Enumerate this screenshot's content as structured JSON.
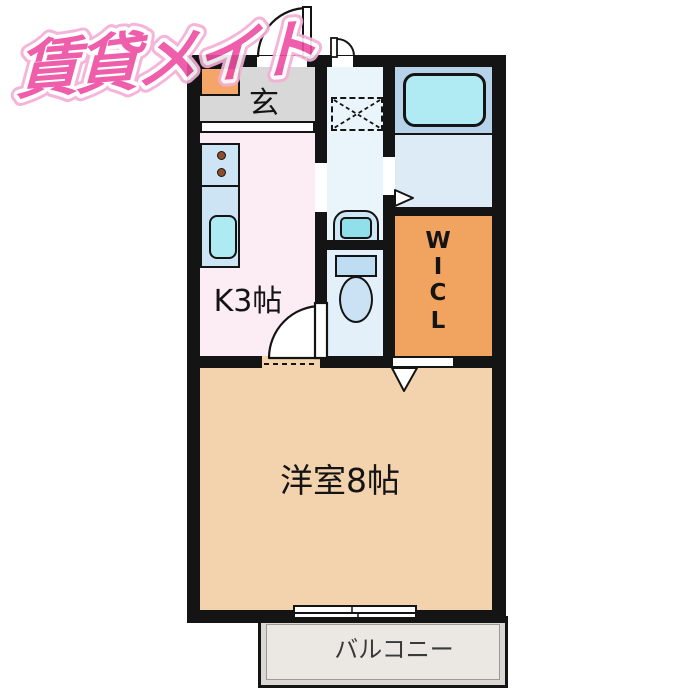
{
  "logo": {
    "text": "賃貸メイト",
    "color": "#ee4da1"
  },
  "plan": {
    "rooms": {
      "entrance": {
        "label": "玄",
        "floor_color": "#d8d8d8"
      },
      "kitchen": {
        "label": "K3帖",
        "floor_color": "#fbedf3"
      },
      "walk_in_closet": {
        "letters": [
          "W",
          "I",
          "C",
          "L"
        ],
        "floor_color": "#f0a45f"
      },
      "living": {
        "label": "洋室8帖",
        "floor_color": "#f3d3ad"
      },
      "balcony": {
        "label": "バルコニー",
        "floor_color": "#dbd7d3"
      },
      "washroom": {
        "floor_color": "#e9f4fb"
      },
      "toilet": {
        "floor_color": "#e3f0fa"
      },
      "bathroom": {
        "floor_color": "#dcebf6"
      }
    },
    "fixtures": [
      "shoe-cabinet",
      "entrance-door",
      "small-door",
      "kitchen-counter",
      "stove-burners",
      "kitchen-sink",
      "washing-machine-space",
      "washbasin",
      "toilet",
      "bathtub",
      "bath-folding-door-marker",
      "wic-folding-door-marker",
      "kitchen-living-door",
      "sliding-window"
    ],
    "colors": {
      "wall": "#141414",
      "bathtub": "#b0ebf4",
      "tub_surround": "#b7d3ea",
      "counter": "#cde4f4",
      "sink": "#aeeaf2",
      "burner": "#8d4f2b",
      "shoe_cabinet": "#f3a667",
      "balcony_inner": "#ebe8e4"
    }
  }
}
